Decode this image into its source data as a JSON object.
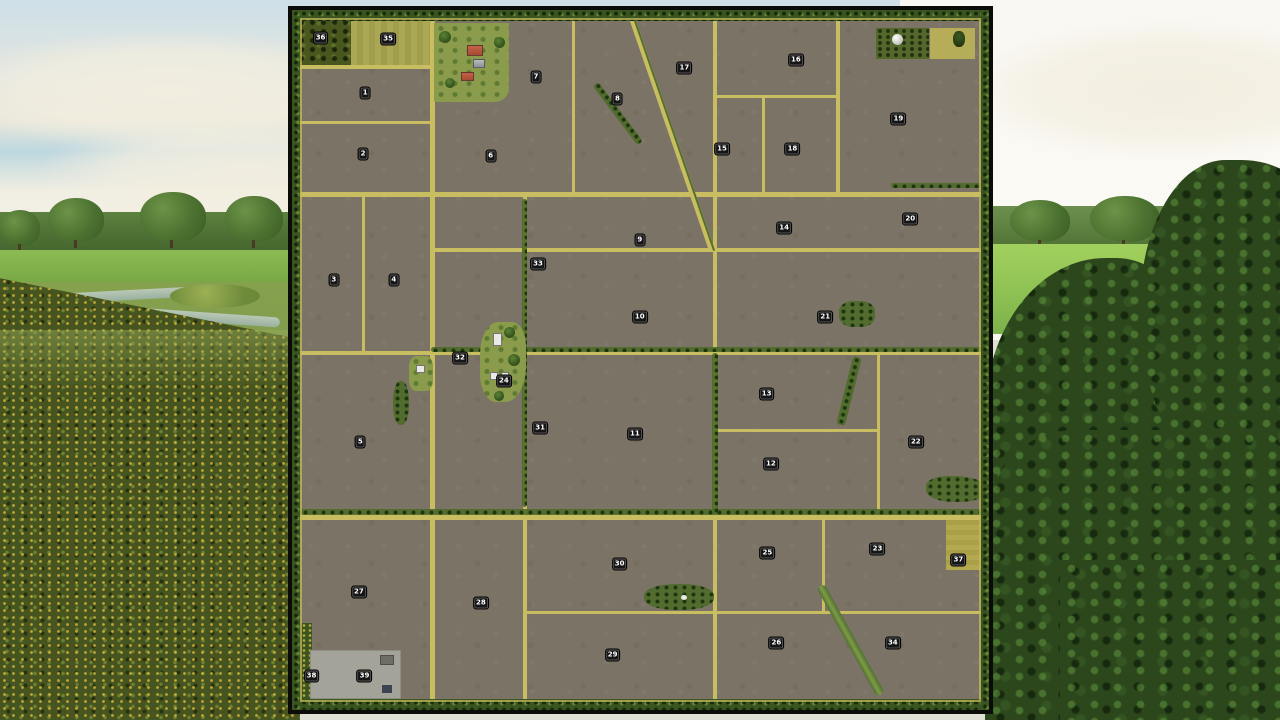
{
  "map": {
    "fields": [
      {
        "n": "1",
        "x": 10.5,
        "y": 11.9
      },
      {
        "n": "2",
        "x": 10.2,
        "y": 20.6
      },
      {
        "n": "3",
        "x": 6.0,
        "y": 38.6
      },
      {
        "n": "4",
        "x": 14.6,
        "y": 38.6
      },
      {
        "n": "5",
        "x": 9.8,
        "y": 61.7
      },
      {
        "n": "6",
        "x": 28.5,
        "y": 20.8
      },
      {
        "n": "7",
        "x": 35.0,
        "y": 9.5
      },
      {
        "n": "8",
        "x": 46.7,
        "y": 12.7
      },
      {
        "n": "9",
        "x": 49.9,
        "y": 32.9
      },
      {
        "n": "10",
        "x": 49.9,
        "y": 43.9
      },
      {
        "n": "11",
        "x": 49.2,
        "y": 60.5
      },
      {
        "n": "12",
        "x": 68.7,
        "y": 64.8
      },
      {
        "n": "13",
        "x": 68.1,
        "y": 54.9
      },
      {
        "n": "14",
        "x": 70.6,
        "y": 31.2
      },
      {
        "n": "15",
        "x": 61.7,
        "y": 19.8
      },
      {
        "n": "16",
        "x": 72.3,
        "y": 7.2
      },
      {
        "n": "17",
        "x": 56.3,
        "y": 8.3
      },
      {
        "n": "18",
        "x": 71.8,
        "y": 19.8
      },
      {
        "n": "19",
        "x": 87.0,
        "y": 15.5
      },
      {
        "n": "20",
        "x": 88.7,
        "y": 29.9
      },
      {
        "n": "21",
        "x": 76.5,
        "y": 43.9
      },
      {
        "n": "22",
        "x": 89.5,
        "y": 61.7
      },
      {
        "n": "23",
        "x": 84.0,
        "y": 77.0
      },
      {
        "n": "24",
        "x": 30.4,
        "y": 53.0
      },
      {
        "n": "25",
        "x": 68.2,
        "y": 77.5
      },
      {
        "n": "26",
        "x": 69.5,
        "y": 90.4
      },
      {
        "n": "27",
        "x": 9.6,
        "y": 83.1
      },
      {
        "n": "28",
        "x": 27.1,
        "y": 84.7
      },
      {
        "n": "29",
        "x": 46.0,
        "y": 92.1
      },
      {
        "n": "30",
        "x": 47.0,
        "y": 79.1
      },
      {
        "n": "31",
        "x": 35.6,
        "y": 59.7
      },
      {
        "n": "32",
        "x": 24.1,
        "y": 49.7
      },
      {
        "n": "33",
        "x": 35.3,
        "y": 36.3
      },
      {
        "n": "34",
        "x": 86.2,
        "y": 90.4
      },
      {
        "n": "35",
        "x": 13.8,
        "y": 4.2
      },
      {
        "n": "36",
        "x": 4.1,
        "y": 4.0
      },
      {
        "n": "37",
        "x": 95.6,
        "y": 78.5
      },
      {
        "n": "38",
        "x": 2.8,
        "y": 95.1
      },
      {
        "n": "39",
        "x": 10.4,
        "y": 95.2
      }
    ]
  },
  "icons": {
    "silo-icon": "white dome circle",
    "tree-icon": "green blob",
    "farm-building-icon": "roof rectangle"
  },
  "colors": {
    "road-yellow": "#c9bd62",
    "field-brown": "#7b7365",
    "hedge-green": "#4c6b28",
    "perimeter-green": "#3a5520",
    "badge-bg": "#151515",
    "badge-text": "#ffffff"
  }
}
